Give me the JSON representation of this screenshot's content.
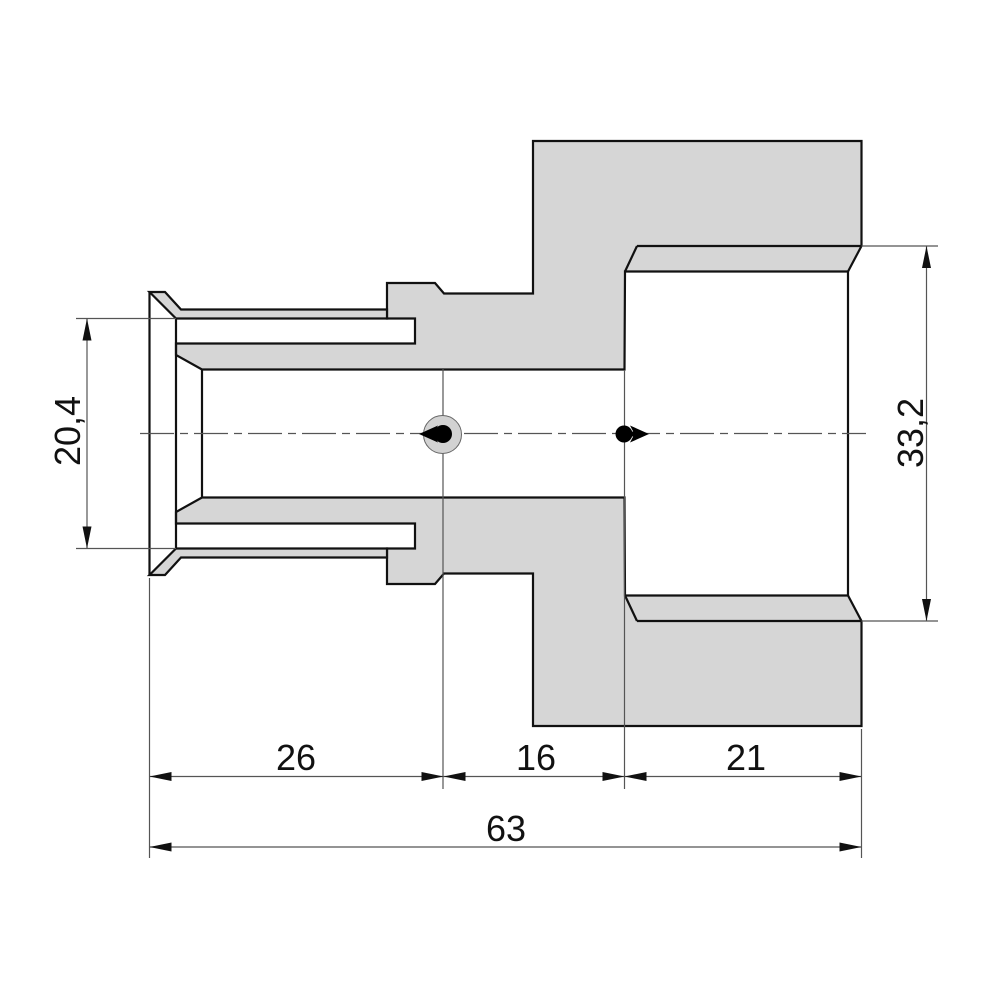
{
  "drawing": {
    "kind": "technical-section-drawing-pipe-fitting",
    "dimensions": {
      "sleeve_inner_diameter": "20,4",
      "thread_diameter": "33,2",
      "sleeve_length": "26",
      "middle_length": "16",
      "thread_length": "21",
      "overall_length": "63"
    },
    "colors": {
      "material_fill": "#d6d6d6",
      "contour_line": "#111111",
      "auxiliary_line": "#555555",
      "flow_marker": "#000000",
      "background": "#ffffff"
    },
    "markers": {
      "left": "flow-arrow-left",
      "right": "flow-arrow-right"
    }
  }
}
